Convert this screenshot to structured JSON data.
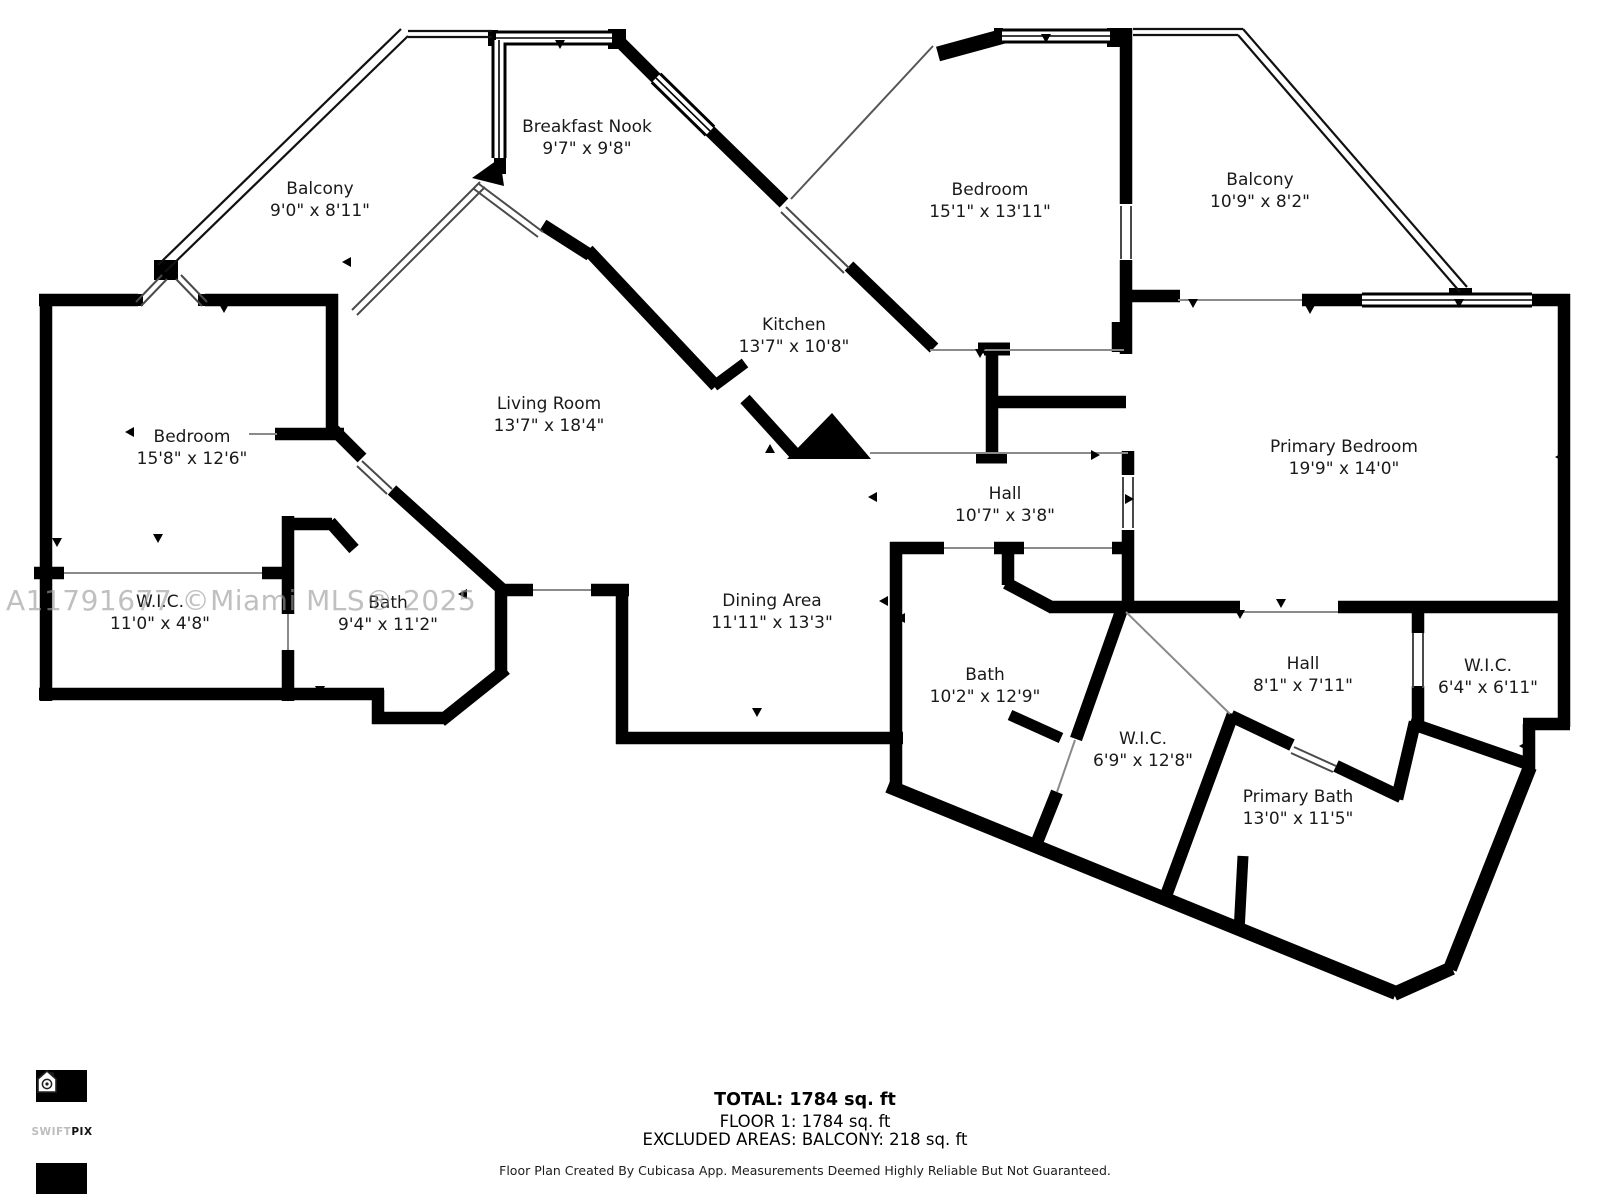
{
  "plan": {
    "watermark": "A11791677 ©Miami MLS® 2025",
    "rooms": [
      {
        "id": "balcony-left",
        "name": "Balcony",
        "dims": "9'0\" x 8'11\""
      },
      {
        "id": "breakfast-nook",
        "name": "Breakfast Nook",
        "dims": "9'7\" x 9'8\""
      },
      {
        "id": "bedroom-top",
        "name": "Bedroom",
        "dims": "15'1\" x 13'11\""
      },
      {
        "id": "balcony-right",
        "name": "Balcony",
        "dims": "10'9\" x 8'2\""
      },
      {
        "id": "kitchen",
        "name": "Kitchen",
        "dims": "13'7\" x 10'8\""
      },
      {
        "id": "living-room",
        "name": "Living Room",
        "dims": "13'7\" x 18'4\""
      },
      {
        "id": "bedroom-left",
        "name": "Bedroom",
        "dims": "15'8\" x 12'6\""
      },
      {
        "id": "primary-bedroom",
        "name": "Primary Bedroom",
        "dims": "19'9\" x 14'0\""
      },
      {
        "id": "hall-center",
        "name": "Hall",
        "dims": "10'7\" x 3'8\""
      },
      {
        "id": "wic-left",
        "name": "W.I.C.",
        "dims": "11'0\" x 4'8\""
      },
      {
        "id": "bath-left",
        "name": "Bath",
        "dims": "9'4\" x 11'2\""
      },
      {
        "id": "dining-area",
        "name": "Dining Area",
        "dims": "11'11\" x 13'3\""
      },
      {
        "id": "bath-right",
        "name": "Bath",
        "dims": "10'2\" x 12'9\""
      },
      {
        "id": "wic-center",
        "name": "W.I.C.",
        "dims": "6'9\" x 12'8\""
      },
      {
        "id": "hall-right",
        "name": "Hall",
        "dims": "8'1\" x 7'11\""
      },
      {
        "id": "wic-right",
        "name": "W.I.C.",
        "dims": "6'4\" x 6'11\""
      },
      {
        "id": "primary-bath",
        "name": "Primary Bath",
        "dims": "13'0\" x 11'5\""
      }
    ],
    "summary": {
      "total": "TOTAL: 1784 sq. ft",
      "floor": "FLOOR 1: 1784 sq. ft",
      "excluded": "EXCLUDED AREAS: BALCONY: 218 sq. ft"
    },
    "disclaimer": "Floor Plan Created By Cubicasa App. Measurements Deemed Highly Reliable But Not Guaranteed.",
    "logo": {
      "brand_light": "SWIFT",
      "brand_bold": "PIX"
    }
  }
}
